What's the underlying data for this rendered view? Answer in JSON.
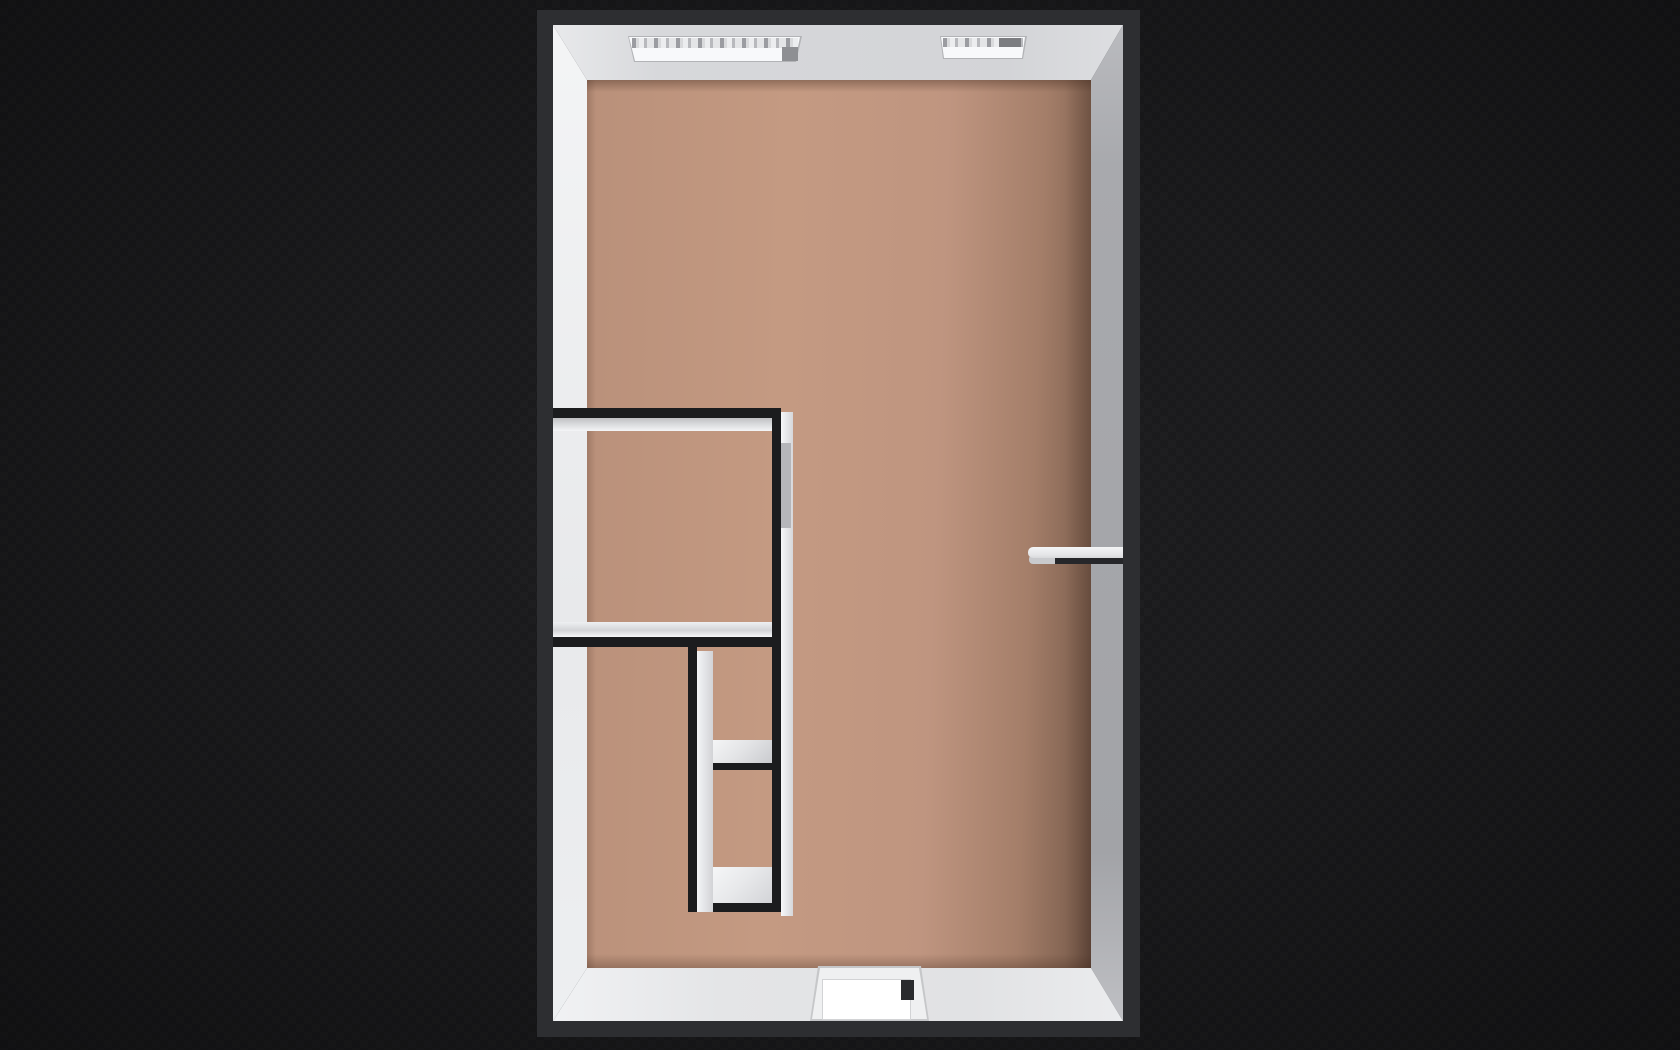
{
  "scene": {
    "description_label": "",
    "view": "top-down-3d-floorplan"
  },
  "colors": {
    "background": "#19191b",
    "outer_wall_top": "#2d2e31",
    "inner_wall_top": "#1b1c1e",
    "floor_base": "#c49a82",
    "floor_dark_edge": "#6b5043",
    "face_left_white": "#eff0f2",
    "face_top_gray": "#d5d6d9",
    "face_right_shadow": "#a6a7ab",
    "face_bottom_light": "#e5e6e8",
    "window_frame": "#b2b3b6",
    "window_glass_dark": "#8e8f93",
    "door_leaf_top": "#e9ebec",
    "door_leaf_shadow": "#26272a",
    "door_panel_white": "#ffffff",
    "door_handle_dark": "#2a2b2e",
    "closet_door_gray": "#b5b6ba"
  },
  "plan": {
    "x": 537,
    "y": 10,
    "w": 603,
    "h": 1027
  },
  "shapes": [
    {
      "name": "inner-face-left",
      "poly": [
        [
          16,
          15
        ],
        [
          50,
          70
        ],
        [
          50,
          958
        ],
        [
          16,
          1011
        ]
      ],
      "fill": {
        "angle": 175,
        "stops": [
          [
            "#f4f5f6",
            0
          ],
          [
            "#e8e9eb",
            55
          ],
          [
            "#eef0f2",
            100
          ]
        ]
      }
    },
    {
      "name": "inner-face-top",
      "poly": [
        [
          16,
          15
        ],
        [
          586,
          15
        ],
        [
          554,
          70
        ],
        [
          50,
          70
        ]
      ],
      "fill": {
        "angle": 90,
        "stops": [
          [
            "#ebecee",
            0
          ],
          [
            "#d7d8db",
            20
          ],
          [
            "#d3d4d7",
            78
          ],
          [
            "#dfe0e3",
            100
          ]
        ]
      }
    },
    {
      "name": "inner-face-right",
      "poly": [
        [
          586,
          15
        ],
        [
          586,
          1011
        ],
        [
          554,
          958
        ],
        [
          554,
          70
        ]
      ],
      "fill": {
        "angle": 180,
        "stops": [
          [
            "#bcbdc1",
            0
          ],
          [
            "#a8a9ad",
            15
          ],
          [
            "#a2a3a7",
            82
          ],
          [
            "#c2c3c7",
            100
          ]
        ]
      }
    },
    {
      "name": "inner-face-bottom",
      "poly": [
        [
          16,
          1011
        ],
        [
          50,
          958
        ],
        [
          554,
          958
        ],
        [
          586,
          1011
        ]
      ],
      "fill": {
        "angle": 90,
        "stops": [
          [
            "#f2f3f5",
            0
          ],
          [
            "#e4e5e7",
            30
          ],
          [
            "#e1e2e4",
            72
          ],
          [
            "#ecedef",
            100
          ]
        ]
      }
    },
    {
      "name": "floor",
      "rect": [
        50,
        70,
        504,
        888
      ],
      "fill": {
        "angle": 92,
        "stops": [
          [
            "#b9907a",
            0
          ],
          [
            "#c49a82",
            38
          ],
          [
            "#bf9580",
            68
          ],
          [
            "#a47e69",
            86
          ],
          [
            "#7e604f",
            97
          ],
          [
            "#6b5043",
            100
          ]
        ]
      }
    },
    {
      "name": "floor-edge-shadow",
      "rect": [
        50,
        70,
        504,
        888
      ],
      "css": "floor-shade"
    },
    {
      "name": "window-recess-left",
      "poly": [
        [
          91,
          26
        ],
        [
          265,
          26
        ],
        [
          259,
          52
        ],
        [
          97,
          52
        ]
      ],
      "fill": "window_frame"
    },
    {
      "name": "window-sill-left",
      "poly": [
        [
          92,
          27
        ],
        [
          263,
          27
        ],
        [
          258,
          51
        ],
        [
          98,
          51
        ]
      ],
      "fill": "#f8f9fb"
    },
    {
      "name": "window-glass-left",
      "rect": [
        95,
        28,
        166,
        10
      ],
      "css": "glass-dashes"
    },
    {
      "name": "window-shade-left",
      "rect": [
        245,
        37,
        16,
        14
      ],
      "fill": "window_glass_dark"
    },
    {
      "name": "window-recess-right",
      "poly": [
        [
          403,
          26
        ],
        [
          490,
          26
        ],
        [
          486,
          49
        ],
        [
          406,
          49
        ]
      ],
      "fill": "window_frame"
    },
    {
      "name": "window-sill-right",
      "poly": [
        [
          404,
          27
        ],
        [
          488,
          27
        ],
        [
          485,
          48
        ],
        [
          407,
          48
        ]
      ],
      "fill": "#f8f9fb"
    },
    {
      "name": "window-glass-right",
      "rect": [
        406,
        28,
        80,
        9
      ],
      "css": "glass-dashes"
    },
    {
      "name": "window-shade-right",
      "rect": [
        462,
        28,
        22,
        9
      ],
      "fill": "#7c7d81"
    },
    {
      "name": "wall-a-face",
      "rect": [
        16,
        408,
        224,
        13
      ],
      "fill": {
        "angle": 180,
        "stops": [
          [
            "#bfc0c3",
            0
          ],
          [
            "#d8d9db",
            45
          ],
          [
            "#f4f5f7",
            100
          ]
        ]
      }
    },
    {
      "name": "wall-a-top",
      "rect": [
        16,
        398,
        224,
        10
      ],
      "fill": "inner_wall_top"
    },
    {
      "name": "wall-c-face",
      "rect": [
        16,
        612,
        230,
        15
      ],
      "fill": {
        "angle": 180,
        "stops": [
          [
            "#eef0f2",
            0
          ],
          [
            "#d3d4d7",
            55
          ],
          [
            "#f5f6f8",
            100
          ]
        ]
      }
    },
    {
      "name": "wall-c-top",
      "rect": [
        16,
        627,
        230,
        10
      ],
      "fill": "inner_wall_top"
    },
    {
      "name": "wall-d-face",
      "rect": [
        160,
        730,
        78,
        23
      ],
      "fill": {
        "angle": 135,
        "stops": [
          [
            "#fbfcfd",
            0
          ],
          [
            "#e3e4e6",
            55
          ],
          [
            "#c8c9cd",
            100
          ]
        ]
      }
    },
    {
      "name": "wall-d-top",
      "rect": [
        151,
        753,
        87,
        7
      ],
      "fill": "inner_wall_top"
    },
    {
      "name": "wall-e-face",
      "rect": [
        160,
        857,
        84,
        36
      ],
      "fill": {
        "angle": 135,
        "stops": [
          [
            "#fafbfc",
            0
          ],
          [
            "#e8e9eb",
            50
          ],
          [
            "#cfd0d4",
            100
          ]
        ]
      }
    },
    {
      "name": "wall-e-top",
      "rect": [
        151,
        893,
        93,
        9
      ],
      "fill": "inner_wall_top"
    },
    {
      "name": "wall-f-face",
      "rect": [
        160,
        641,
        16,
        261
      ],
      "fill": {
        "angle": 90,
        "stops": [
          [
            "#f4f5f7",
            0
          ],
          [
            "#d2d3d6",
            100
          ]
        ]
      }
    },
    {
      "name": "wall-f-top",
      "rect": [
        151,
        637,
        9,
        265
      ],
      "fill": "inner_wall_top"
    },
    {
      "name": "wall-b-face",
      "rect": [
        244,
        402,
        12,
        504
      ],
      "fill": {
        "angle": 90,
        "stops": [
          [
            "#f6f7f9",
            0
          ],
          [
            "#d6d7da",
            100
          ]
        ]
      }
    },
    {
      "name": "closet-door-panel",
      "rect": [
        244,
        433,
        10,
        85
      ],
      "fill": "closet_door_gray"
    },
    {
      "name": "wall-b-top",
      "rect": [
        235,
        398,
        9,
        504
      ],
      "fill": "inner_wall_top"
    },
    {
      "name": "door-leaf-shadow",
      "rect": [
        511,
        546,
        75,
        8
      ],
      "fill": "door_leaf_shadow"
    },
    {
      "name": "door-leaf-underside",
      "rect": [
        492,
        545,
        26,
        9
      ],
      "fill": "#c9cacd",
      "radius": "4px 0 0 4px"
    },
    {
      "name": "door-leaf-top",
      "rect": [
        491,
        537,
        95,
        11
      ],
      "fill": {
        "angle": 180,
        "stops": [
          [
            "#f4f5f6",
            0
          ],
          [
            "#e5e6e8",
            70
          ],
          [
            "#d8d9db",
            100
          ]
        ]
      },
      "radius": "5px 0 0 5px"
    },
    {
      "name": "entry-door-recess",
      "poly": [
        [
          281,
          956
        ],
        [
          384,
          956
        ],
        [
          392,
          1011
        ],
        [
          273,
          1011
        ]
      ],
      "fill": "#c6c7c9"
    },
    {
      "name": "entry-door-jamb",
      "poly": [
        [
          283,
          958
        ],
        [
          382,
          958
        ],
        [
          390,
          1009
        ],
        [
          275,
          1009
        ]
      ],
      "fill": "#eff0f1"
    },
    {
      "name": "entry-door-panel",
      "rect": [
        285,
        969,
        87,
        39
      ],
      "fill": "door_panel_white",
      "border": "1px solid #d2d3d5"
    },
    {
      "name": "entry-door-handle",
      "rect": [
        364,
        970,
        13,
        20
      ],
      "fill": "door_handle_dark"
    }
  ]
}
